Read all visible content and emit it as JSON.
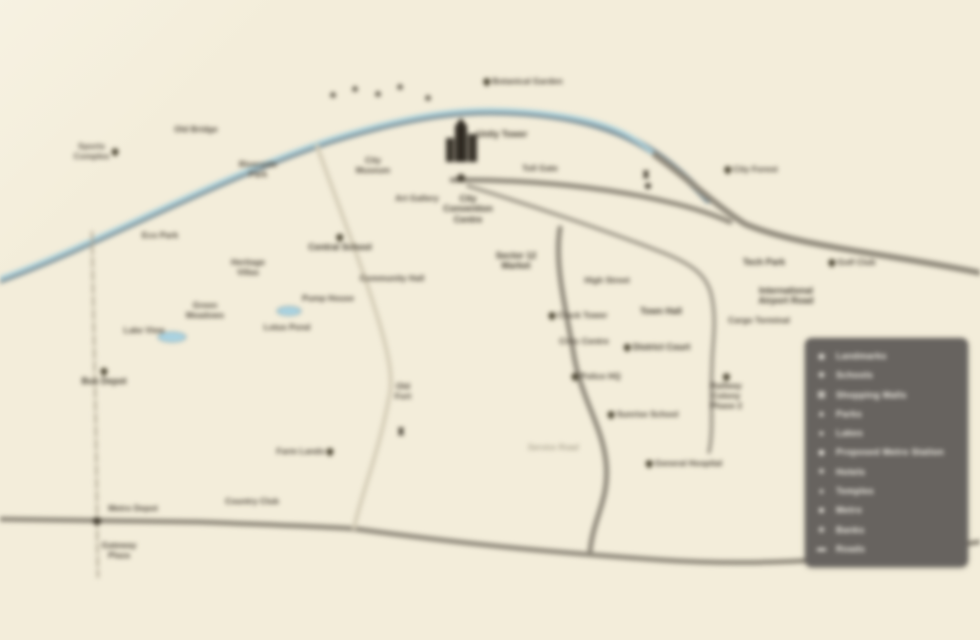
{
  "map": {
    "background_color": "#f3edda",
    "pond_color": "#aad3e2",
    "pond_stroke": "#86a4ab",
    "roads": [
      {
        "name": "river-casing",
        "path": "M -8 283 C 90 249 208 182 330 141 C 420 113 478 106 552 116 C 618 125 660 148 708 200",
        "color": "#7e9199",
        "width": 7
      },
      {
        "name": "river-water",
        "path": "M -8 281 C 90 247 208 180 330 139 C 420 111 478 104 552 114 C 605 121 632 133 655 155",
        "color": "#aed2db",
        "width": 4
      },
      {
        "name": "main-east-road",
        "path": "M 655 155 C 690 180 715 205 745 224 C 800 247 880 252 986 274",
        "color": "#8f897b",
        "width": 6
      },
      {
        "name": "junction-east-road",
        "path": "M 452 180 C 530 179 610 188 668 202 C 690 207 712 214 730 222",
        "color": "#8f897b",
        "width": 5
      },
      {
        "name": "southeast-branch-road",
        "path": "M 468 186 C 540 208 612 233 656 250 C 694 264 708 276 712 298 C 717 324 712 345 712 366 C 710 404 714 428 709 452",
        "color": "#9a9486",
        "width": 3.5
      },
      {
        "name": "south-curve-road",
        "path": "M 560 228 C 554 264 566 310 573 350 C 580 398 602 424 606 462 C 610 500 593 517 590 552",
        "color": "#8f897b",
        "width": 5
      },
      {
        "name": "bottom-cross-road",
        "path": "M -8 519 L 200 522 C 300 526 332 527 356 529 C 480 546 562 553 662 560 C 782 568 882 556 986 541",
        "color": "#8f897b",
        "width": 5
      },
      {
        "name": "light-diagonal-road",
        "path": "M 317 146 C 338 205 362 265 379 322 C 391 362 393 383 389 398 C 379 452 362 492 354 528",
        "color": "#d4ccb6",
        "width": 4
      },
      {
        "name": "left-vertical-road",
        "path": "M 92 232 C 93 300 95 380 96 440 C 97 490 97 540 98 577",
        "color": "#b8b09c",
        "width": 2.5,
        "dash": "9 4"
      }
    ],
    "ponds": [
      {
        "cx": 172,
        "cy": 337,
        "rx": 14,
        "ry": 5
      },
      {
        "cx": 289,
        "cy": 311,
        "rx": 12,
        "ry": 4.5
      }
    ],
    "dots": [
      {
        "x": 461,
        "y": 178,
        "r": 4
      },
      {
        "x": 97,
        "y": 521,
        "r": 4
      },
      {
        "x": 648,
        "y": 186,
        "r": 3
      }
    ],
    "labels": [
      {
        "x": 96,
        "y": 152,
        "text": "Sports\nComplex",
        "icon": "right"
      },
      {
        "x": 196,
        "y": 130,
        "text": "Old Bridge"
      },
      {
        "x": 258,
        "y": 170,
        "text": "Riverside\nPark"
      },
      {
        "x": 333,
        "y": 96,
        "glyph": "♣",
        "name": "tree-icon"
      },
      {
        "x": 355,
        "y": 90,
        "glyph": "♣",
        "name": "tree-icon"
      },
      {
        "x": 378,
        "y": 95,
        "glyph": "♣",
        "name": "tree-icon"
      },
      {
        "x": 400,
        "y": 88,
        "glyph": "♣",
        "name": "tree-icon"
      },
      {
        "x": 428,
        "y": 99,
        "glyph": "♣",
        "name": "tree-icon"
      },
      {
        "x": 523,
        "y": 82,
        "text": "Botanical Garden",
        "icon": "left"
      },
      {
        "x": 373,
        "y": 166,
        "text": "City\nMuseum"
      },
      {
        "x": 417,
        "y": 199,
        "text": "Art Gallery"
      },
      {
        "x": 340,
        "y": 243,
        "text": "Central School",
        "icon": "above",
        "bold": true
      },
      {
        "x": 392,
        "y": 279,
        "text": "Community Hall"
      },
      {
        "x": 328,
        "y": 299,
        "text": "Pump House"
      },
      {
        "x": 160,
        "y": 236,
        "text": "Eco Park"
      },
      {
        "x": 248,
        "y": 268,
        "text": "Heritage\nVillas"
      },
      {
        "x": 205,
        "y": 311,
        "text": "Green\nMeadows"
      },
      {
        "x": 144,
        "y": 331,
        "text": "Lake View"
      },
      {
        "x": 287,
        "y": 328,
        "text": "Lotus Pond"
      },
      {
        "x": 104,
        "y": 377,
        "text": "Bus Depot",
        "icon": "above",
        "bold": true
      },
      {
        "x": 502,
        "y": 134,
        "text": "Unity Tower",
        "bold": true
      },
      {
        "x": 540,
        "y": 169,
        "text": "Toll Gate"
      },
      {
        "x": 468,
        "y": 209,
        "text": "City\nConvention\nCentre",
        "bold": true
      },
      {
        "x": 516,
        "y": 261,
        "text": "Sector 12\nMarket",
        "bold": true
      },
      {
        "x": 607,
        "y": 281,
        "text": "High Street"
      },
      {
        "x": 578,
        "y": 316,
        "text": "Clock Tower",
        "icon": "left"
      },
      {
        "x": 661,
        "y": 311,
        "text": "Town Hall",
        "bold": true
      },
      {
        "x": 584,
        "y": 342,
        "text": "Civic Centre"
      },
      {
        "x": 657,
        "y": 347,
        "text": "District Court",
        "icon": "left",
        "bold": true
      },
      {
        "x": 596,
        "y": 377,
        "text": "Police HQ",
        "icon": "left"
      },
      {
        "x": 646,
        "y": 176,
        "glyph": "♜",
        "name": "tower-icon"
      },
      {
        "x": 643,
        "y": 415,
        "text": "Sunrise School",
        "icon": "left"
      },
      {
        "x": 684,
        "y": 464,
        "text": "General Hospital",
        "icon": "left"
      },
      {
        "x": 726,
        "y": 392,
        "text": "Railway\nColony\nPhase 2",
        "icon": "above"
      },
      {
        "x": 764,
        "y": 262,
        "text": "Tech Park",
        "bold": true
      },
      {
        "x": 852,
        "y": 263,
        "text": "Golf Club",
        "icon": "left"
      },
      {
        "x": 786,
        "y": 296,
        "text": "International\nAirport Road",
        "bold": true
      },
      {
        "x": 759,
        "y": 321,
        "text": "Cargo Terminal"
      },
      {
        "x": 751,
        "y": 170,
        "text": "City Forest",
        "icon": "left"
      },
      {
        "x": 403,
        "y": 392,
        "text": "Old\nFort"
      },
      {
        "x": 401,
        "y": 433,
        "glyph": "♜",
        "name": "fort-icon"
      },
      {
        "x": 305,
        "y": 452,
        "text": "Farm Lands",
        "icon": "right"
      },
      {
        "x": 252,
        "y": 502,
        "text": "Country Club"
      },
      {
        "x": 553,
        "y": 448,
        "text": "Service Road",
        "light": true
      },
      {
        "x": 133,
        "y": 509,
        "text": "Metro Depot"
      },
      {
        "x": 119,
        "y": 551,
        "text": "Gateway\nPlaza"
      }
    ]
  },
  "legend": {
    "bg": "#67635f",
    "x": 805,
    "y": 338,
    "w": 163,
    "h": 229,
    "rows": [
      {
        "glyph": "◉",
        "label": "Landmarks"
      },
      {
        "glyph": "✚",
        "label": "Schools"
      },
      {
        "glyph": "▦",
        "label": "Shopping Malls"
      },
      {
        "glyph": "▲",
        "label": "Parks"
      },
      {
        "glyph": "●",
        "label": "Lakes"
      },
      {
        "glyph": "◆",
        "label": "Proposed Metro Station"
      },
      {
        "glyph": "★",
        "label": "Hotels"
      },
      {
        "glyph": "♦",
        "label": "Temples"
      },
      {
        "glyph": "■",
        "label": "Metro"
      },
      {
        "glyph": "◈",
        "label": "Banks"
      },
      {
        "glyph": "▬",
        "label": "Roads"
      }
    ]
  }
}
